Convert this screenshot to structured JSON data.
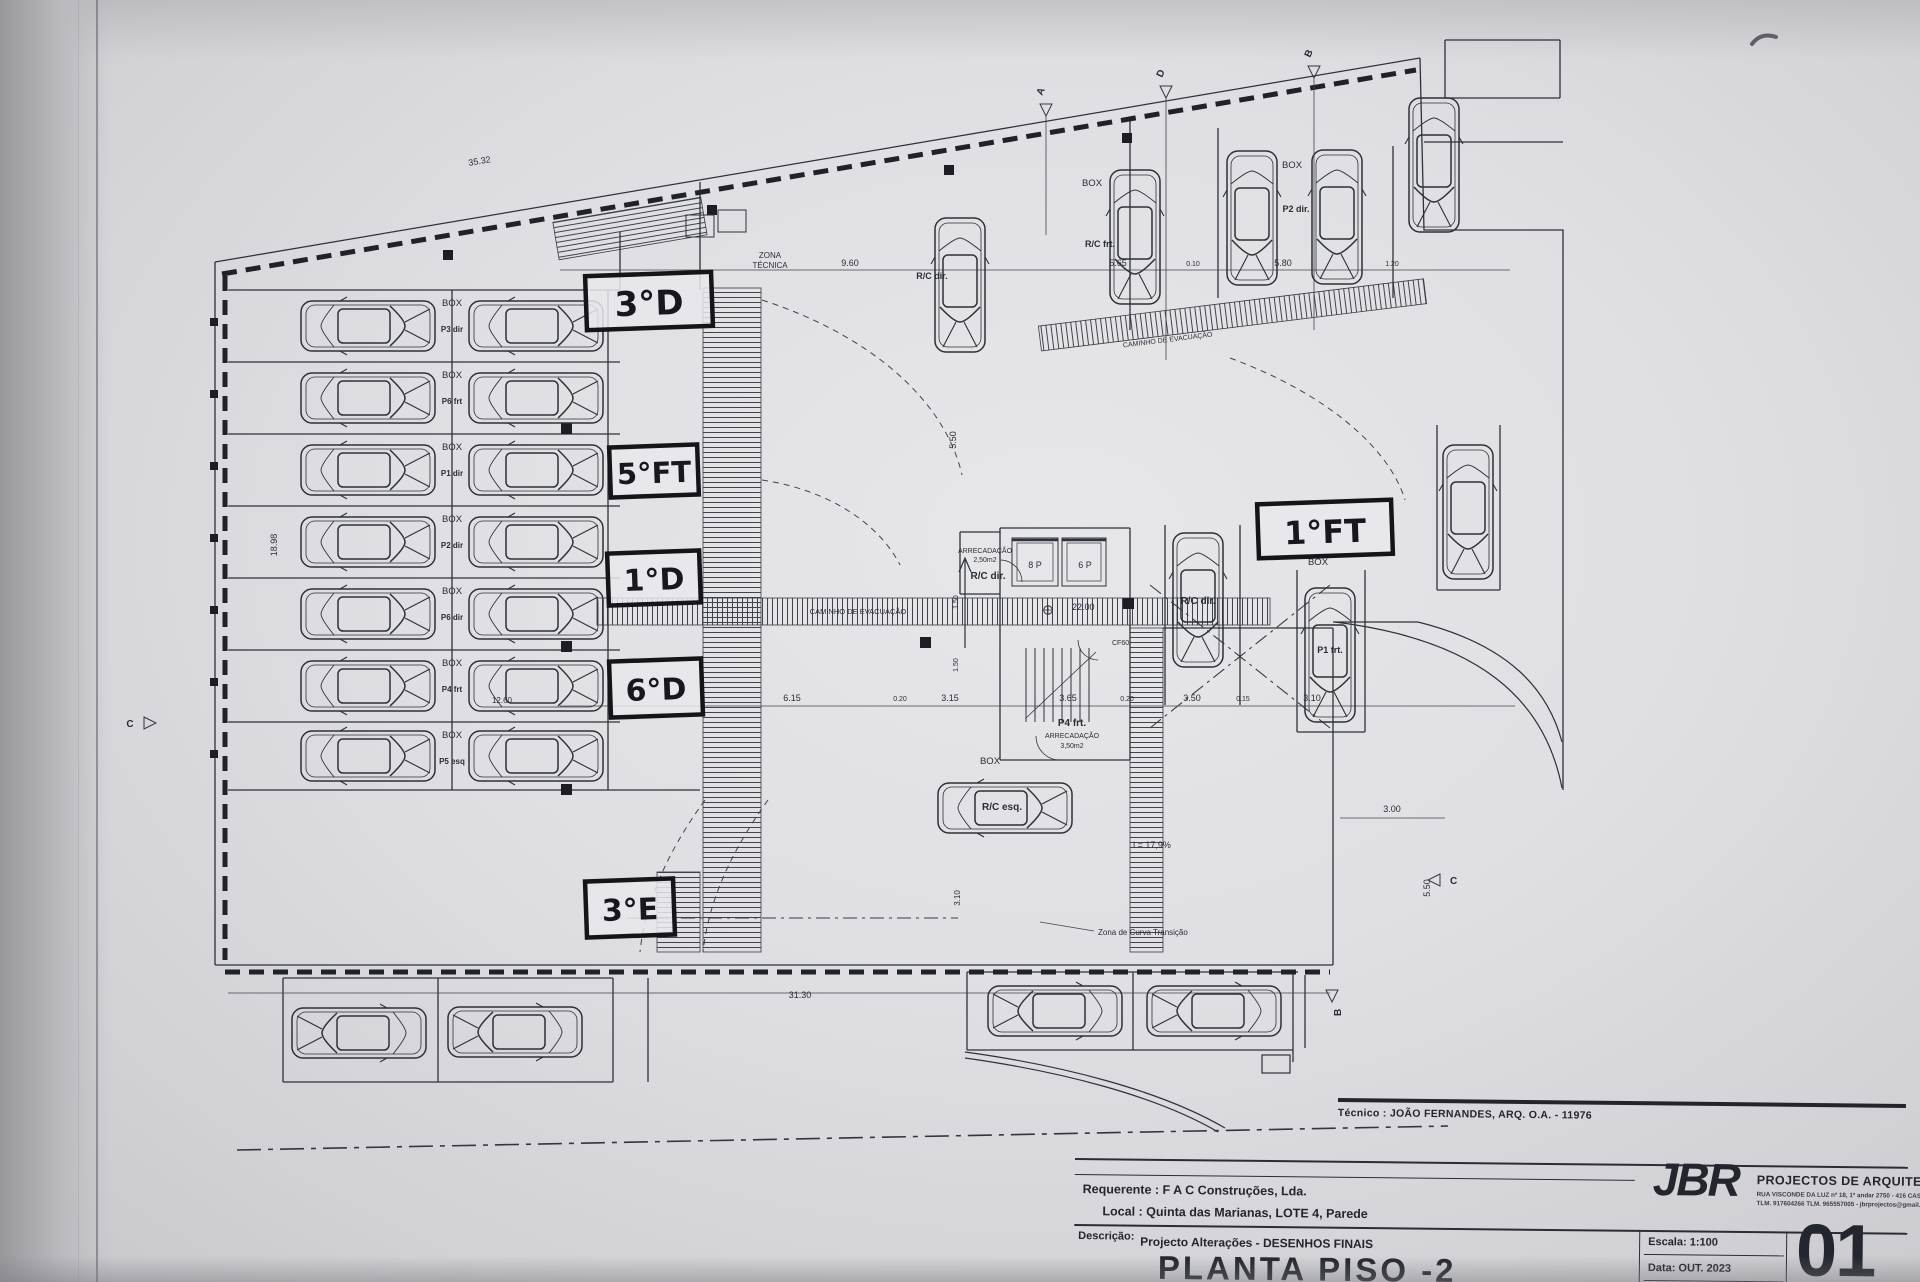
{
  "titleblock": {
    "tecnico": "Técnico : JOÃO FERNANDES, ARQ.   O.A. - 11976",
    "requerente": "Requerente : F A C  Construções, Lda.",
    "local": "Local : Quinta das Marianas, LOTE 4, Parede",
    "descricao_label": "Descrição:",
    "descricao": "Projecto Alterações - DESENHOS FINAIS",
    "title": "PLANTA PISO -2",
    "firm_initials": "JBR",
    "firm_name": "PROJECTOS DE ARQUITECTURA",
    "firm_address1": "RUA VISCONDE DA LUZ nº 18, 1º andar  2750 - 416  CASCAIS",
    "firm_address2": "TLM. 917604266  TLM. 965557005 - jbrprojectos@gmail.com",
    "escala": "Escala: 1:100",
    "data": "Data: OUT. 2023",
    "sheet_number": "01"
  },
  "handwritten": {
    "apt_3d": "3°D",
    "apt_5ft": "5°FT",
    "apt_1d": "1°D",
    "apt_6d": "6°D",
    "apt_3e": "3°E",
    "apt_1ft": "1°FT"
  },
  "labels": {
    "box": "BOX",
    "zona": "ZONA",
    "tecnica": "TÉCNICA",
    "caminho": "CAMINHO DE EVACUAÇÃO",
    "rc_dir": "R/C dir.",
    "rc_frt": "R/C frt.",
    "rc_esq": "R/C esq.",
    "p2_dir": "P2 dir.",
    "p1_frt": "P1 frt.",
    "p4_frt": "P4 frt.",
    "arrecadacao": "ARRECADAÇÃO",
    "arrecadacao_area_small": "2,50m2",
    "arrecadacao_area_big": "3,50m2",
    "elev_8p": "8 P",
    "elev_6p": "6 P",
    "level": "22.00",
    "door": "CF60",
    "slope": "i = 17,9%",
    "curve_zone": "Zona de Curva Transição"
  },
  "parking_rows": [
    {
      "box": "BOX",
      "code": "P3 dir"
    },
    {
      "box": "BOX",
      "code": "P6 frt"
    },
    {
      "box": "BOX",
      "code": "P1 dir"
    },
    {
      "box": "BOX",
      "code": "P2 dir"
    },
    {
      "box": "BOX",
      "code": "P6 dir"
    },
    {
      "box": "BOX",
      "code": "P4 frt"
    },
    {
      "box": "BOX",
      "code": "P5 esq"
    }
  ],
  "dimensions": {
    "top_slant": "35.32",
    "d960": "9.60",
    "d565": "5.65",
    "d010": "0.10",
    "d580": "5.80",
    "d120": "1.20",
    "d615": "6.15",
    "d020a": "0.20",
    "d315": "3.15",
    "d365": "3.65",
    "d020b": "0.20",
    "d350": "3.50",
    "d015": "0.15",
    "d310": "3.10",
    "d1260": "12.60",
    "d3130": "31.30",
    "d1898": "18.98",
    "d550a": "5.50",
    "d550b": "5.50",
    "d150a": "1.50",
    "d150b": "1.50",
    "d310r": "3.10",
    "d300": "3.00"
  },
  "section_markers": {
    "a": "A",
    "b": "B",
    "c": "C",
    "d": "D"
  }
}
